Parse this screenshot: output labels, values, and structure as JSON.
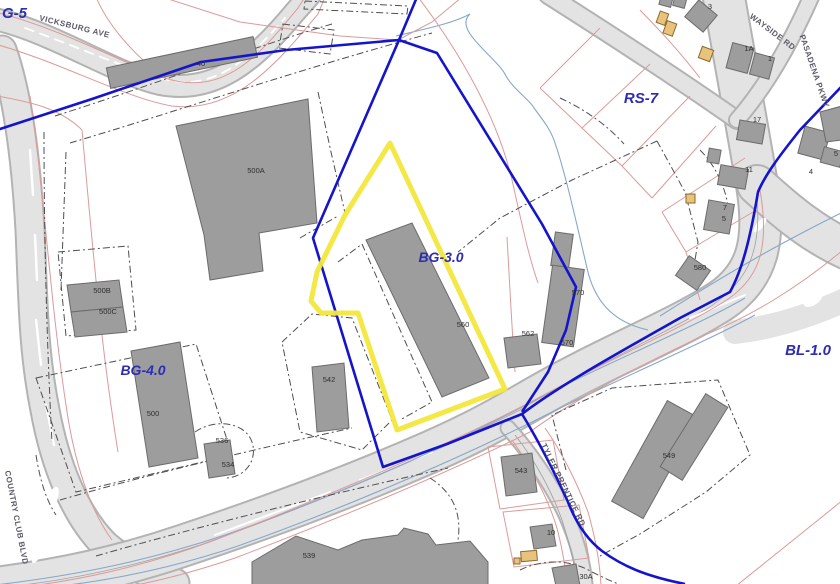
{
  "map": {
    "type": "municipal zoning / parcel GIS map",
    "zones": {
      "g5": "G-5",
      "rs7": "RS-7",
      "bg3": "BG-3.0",
      "bg4": "BG-4.0",
      "bl1": "BL-1.0"
    },
    "streets": {
      "vicksburg": "VICKSBURG AVE",
      "wayside": "WAYSIDE RD",
      "pasadena": "PASADENA PKWY",
      "country": "COUNTRY CLUB BLVD",
      "tyler": "TYLER PRENTICE RD"
    },
    "buildings": {
      "b40": "40",
      "b500a": "500A",
      "b500b": "500B",
      "b500c": "500C",
      "b500": "500",
      "b536": "536",
      "b534": "534",
      "b542": "542",
      "b560": "560",
      "b562": "562",
      "b570u": "570",
      "b570l": "570",
      "b580": "580",
      "b3": "3",
      "b1a": "1A",
      "b1": "1",
      "b17": "17",
      "b11": "11",
      "b7": "7",
      "b5": "5",
      "b4": "4",
      "b5e": "5",
      "b543": "543",
      "b549": "549",
      "b539": "539",
      "b10": "10",
      "b30a": "30A"
    },
    "colors": {
      "zone_boundary": "#1414cc",
      "highlight_parcel": "#f2e73b",
      "parcel_line": "#dc9a9a",
      "building_fill": "#9d9d9d",
      "road_fill": "#e3e3e3",
      "water_line": "#85a8c8",
      "zone_label": "#2d2db4",
      "shed_fill": "#e9c37c",
      "curb_dash": "#4f4f4f"
    }
  }
}
